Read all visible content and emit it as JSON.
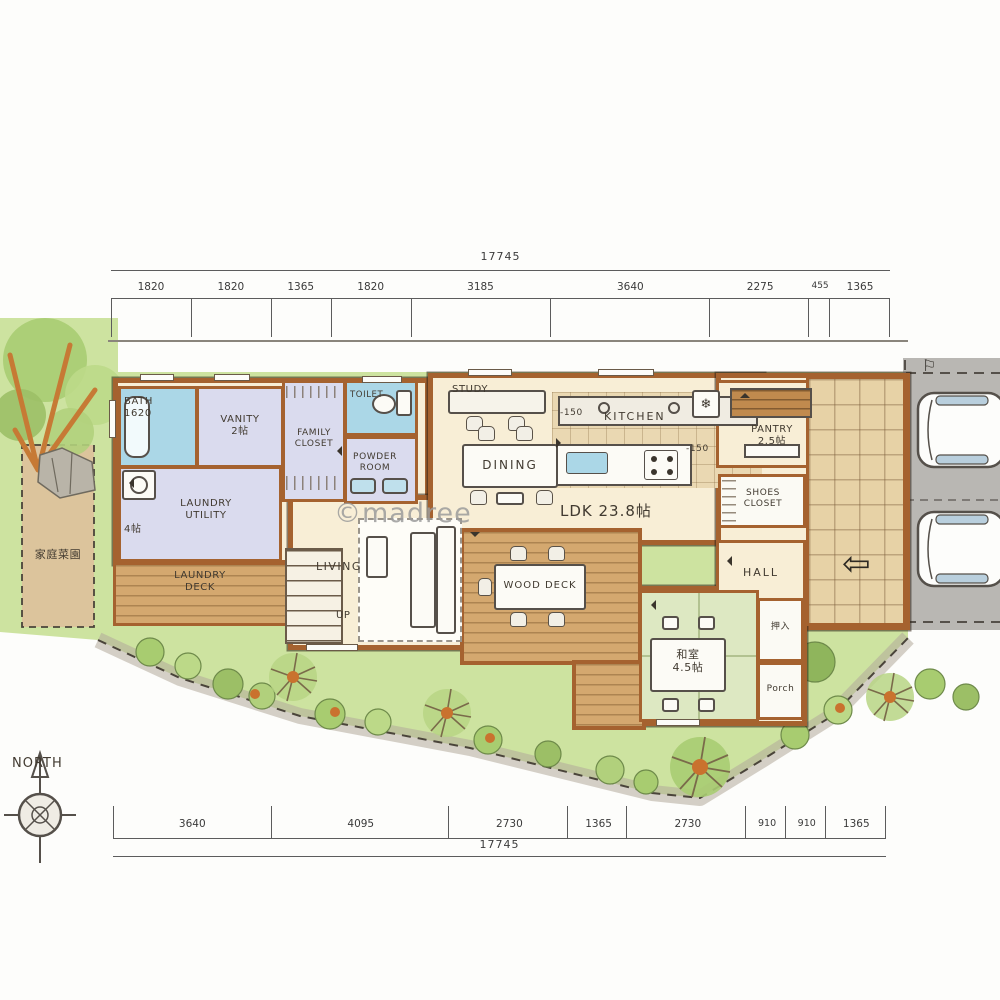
{
  "watermark": "©madree",
  "compass": {
    "label": "NORTH"
  },
  "garden": {
    "patch_label": "家庭菜園"
  },
  "icons": {
    "entry_arrow": "⇦",
    "gate_flag": "⚐",
    "fridge": "❄"
  },
  "annotations": {
    "up": "UP",
    "level_kitchen": "-150",
    "level_entry": "-150",
    "ldk": "LDK 23.8帖"
  },
  "rooms": {
    "bath": {
      "name": "BATH",
      "size": "1620"
    },
    "vanity": {
      "name": "VANITY",
      "size": "2帖"
    },
    "family_closet": {
      "line1": "FAMILY",
      "line2": "CLOSET"
    },
    "toilet": {
      "name": "TOILET"
    },
    "powder_room": {
      "line1": "POWDER",
      "line2": "ROOM"
    },
    "laundry_utility": {
      "line1": "LAUNDRY",
      "line2": "UTILITY",
      "size": "4帖"
    },
    "laundry_deck": {
      "line1": "LAUNDRY",
      "line2": "DECK"
    },
    "living": {
      "name": "LIVING"
    },
    "study": {
      "name": "STUDY"
    },
    "dining": {
      "name": "DINING"
    },
    "kitchen": {
      "name": "KITCHEN"
    },
    "pantry": {
      "name": "PANTRY",
      "size": "2.5帖"
    },
    "shoes_closet": {
      "line1": "SHOES",
      "line2": "CLOSET"
    },
    "hall": {
      "name": "HALL"
    },
    "wood_deck": {
      "name": "WOOD DECK"
    },
    "washitsu": {
      "name": "和室",
      "size": "4.5帖"
    },
    "oshiire": {
      "name": "押入"
    },
    "porch": {
      "name": "Porch"
    }
  },
  "dimensions": {
    "top": {
      "total": "17745",
      "segments": [
        "1820",
        "1820",
        "1365",
        "1820",
        "3185",
        "3640",
        "2275",
        "455",
        "1365"
      ]
    },
    "bottom": {
      "total": "17745",
      "segments": [
        "3640",
        "4095",
        "2730",
        "1365",
        "2730",
        "910",
        "910",
        "1365"
      ]
    }
  },
  "colors": {
    "wall": "#a5622f",
    "water_blue": "#abd7e7",
    "lavender": "#dadbee",
    "tatami_green": "#dde8c2",
    "deck_wood": "#d4a86f",
    "grass": "#cde3a0",
    "driveway": "#b9b7b3",
    "entry_tile": "#e7d2a6",
    "floor_cream": "#f8eed6"
  }
}
